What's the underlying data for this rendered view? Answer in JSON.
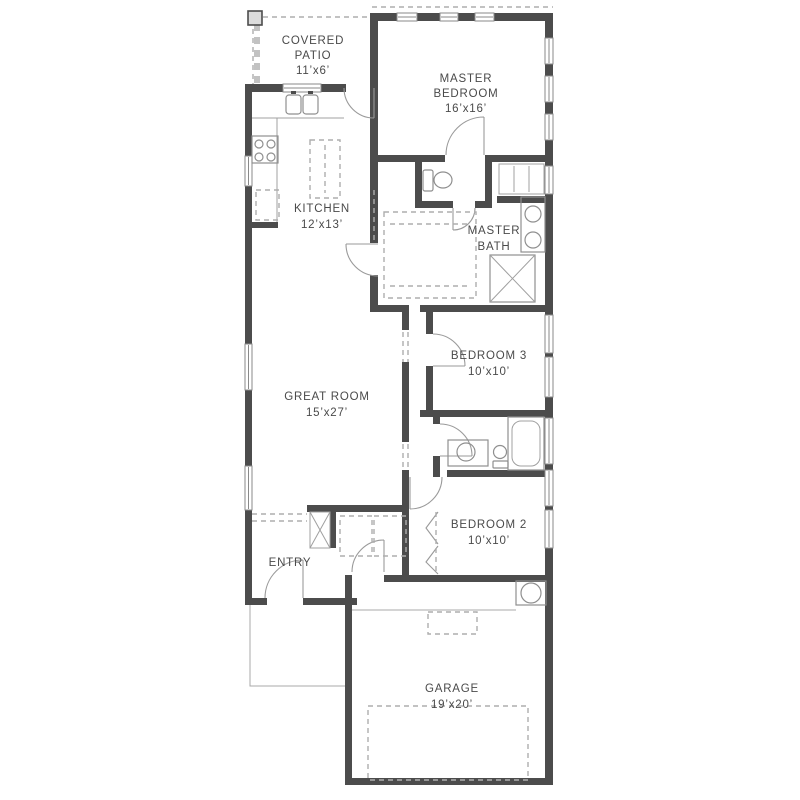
{
  "rooms": {
    "covered_patio": {
      "lines": [
        "COVERED",
        "PATIO",
        "11’x6’"
      ]
    },
    "master_bedroom": {
      "lines": [
        "MASTER",
        "BEDROOM",
        "16’x16’"
      ]
    },
    "kitchen": {
      "lines": [
        "KITCHEN",
        "12’x13’"
      ]
    },
    "master_bath": {
      "lines": [
        "MASTER",
        "BATH"
      ]
    },
    "great_room": {
      "lines": [
        "GREAT ROOM",
        "15’x27’"
      ]
    },
    "bedroom_3": {
      "lines": [
        "BEDROOM 3",
        "10’x10’"
      ]
    },
    "bedroom_2": {
      "lines": [
        "BEDROOM 2",
        "10’x10’"
      ]
    },
    "entry": {
      "lines": [
        "ENTRY"
      ]
    },
    "garage": {
      "lines": [
        "GARAGE",
        "19’x20’"
      ]
    }
  },
  "colors": {
    "wall": "#4c4c4c",
    "fixture_line": "#8f8f8f",
    "dashed_line": "#aeaeae",
    "label_text": "#4a4a4a"
  }
}
